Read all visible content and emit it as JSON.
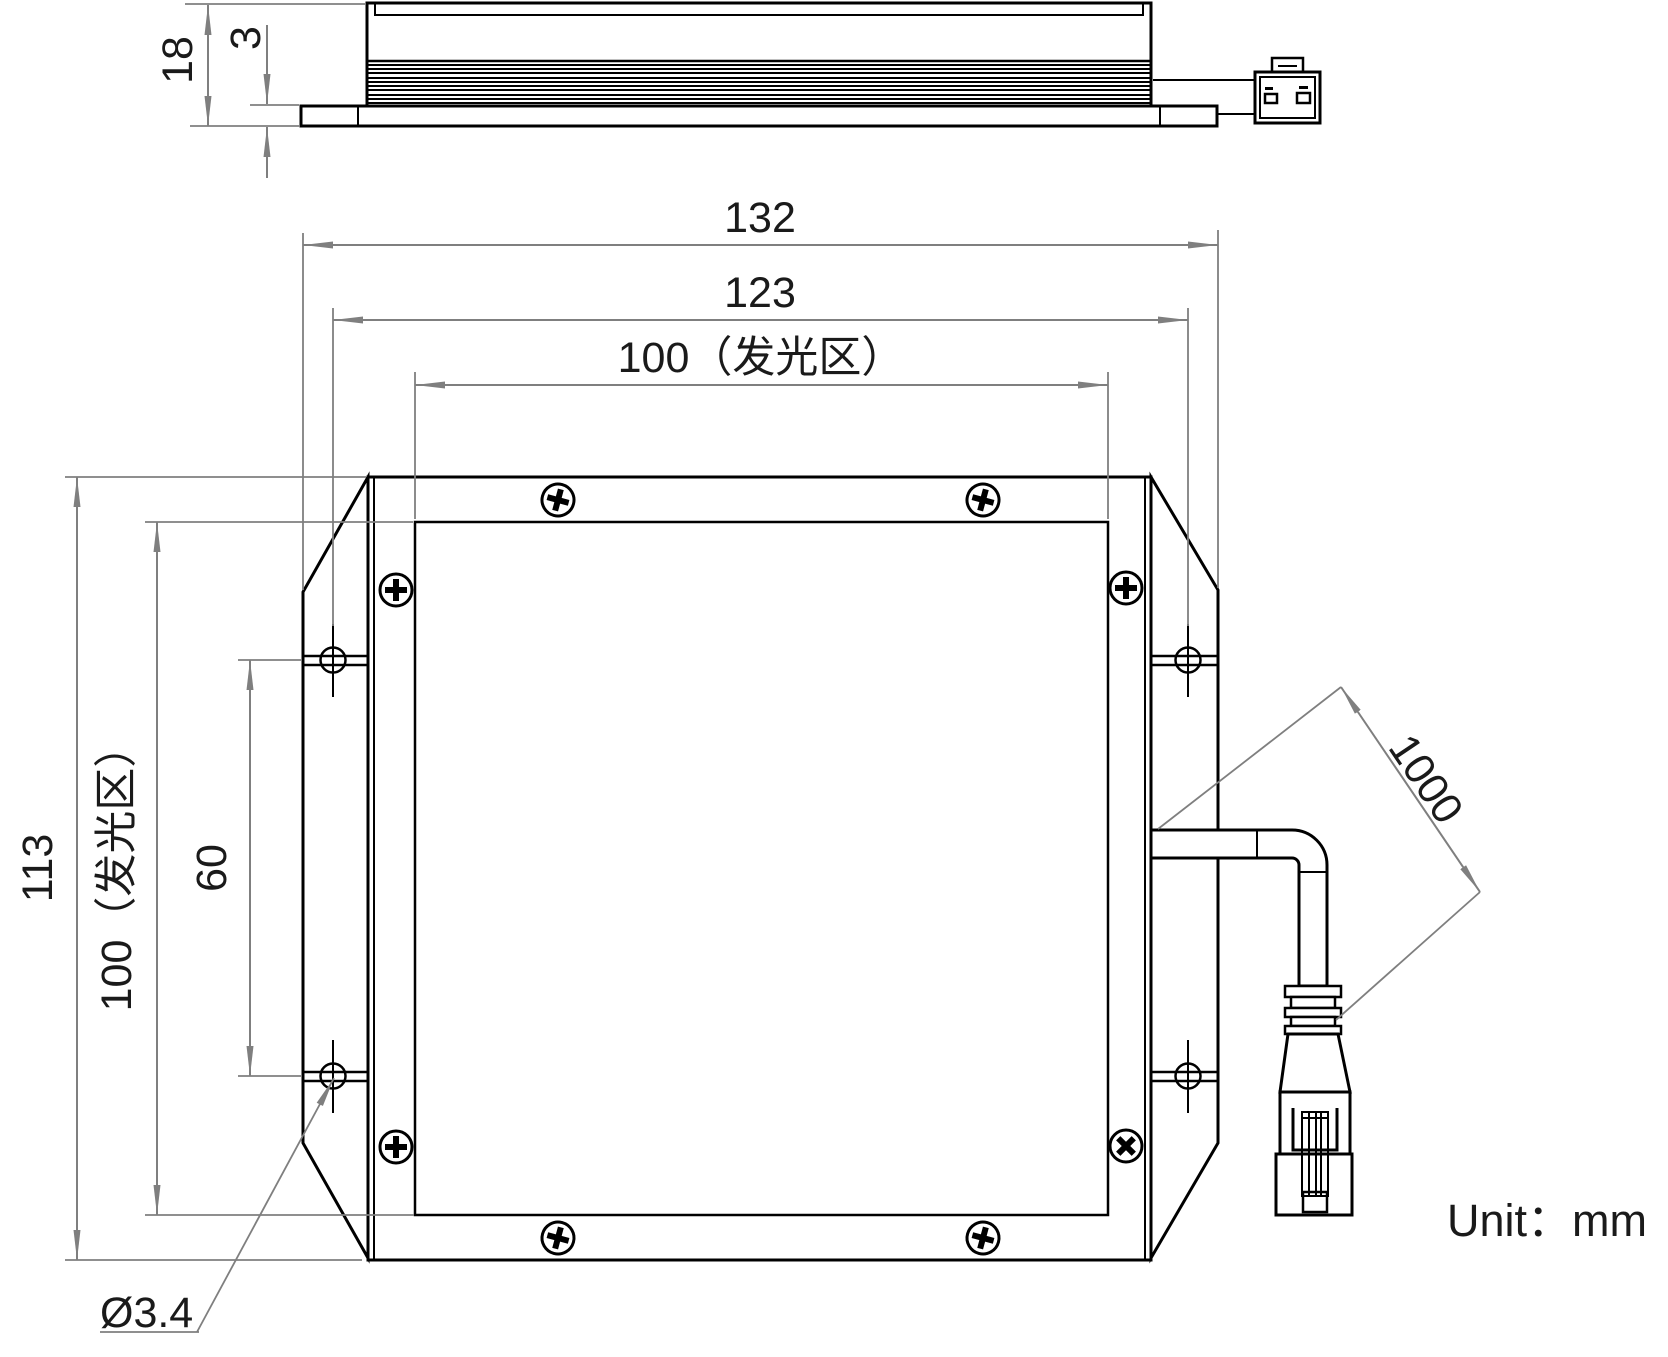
{
  "drawing": {
    "unit_label": "Unit：mm",
    "dims": {
      "side_height": "18",
      "side_base": "3",
      "width_overall": "132",
      "width_holes": "123",
      "width_glow": "100（发光区）",
      "height_overall": "113",
      "height_glow": "100（发光区）",
      "holes_vertical": "60",
      "hole_dia": "Ø3.4",
      "cable_len": "1000"
    },
    "colors": {
      "line": "#000000",
      "dim_line": "#7f7f7f",
      "background": "#ffffff"
    }
  }
}
